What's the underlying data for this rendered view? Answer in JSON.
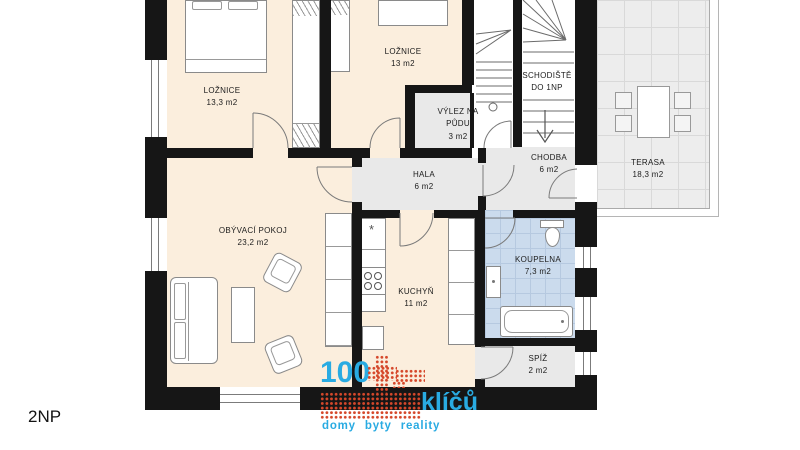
{
  "floor_label": "2NP",
  "rooms": [
    {
      "name": "LOŽNICE",
      "area": "13,3 m2"
    },
    {
      "name": "LOŽNICE",
      "area": "13 m2"
    },
    {
      "name": "VÝLEZ NA PŮDU",
      "area": "3 m2"
    },
    {
      "name": "SCHODIŠTĚ DO 1NP",
      "area": ""
    },
    {
      "name": "CHODBA",
      "area": "6 m2"
    },
    {
      "name": "TERASA",
      "area": "18,3 m2"
    },
    {
      "name": "HALA",
      "area": "6 m2"
    },
    {
      "name": "OBÝVACÍ POKOJ",
      "area": "23,2 m2"
    },
    {
      "name": "KUCHYŇ",
      "area": "11 m2"
    },
    {
      "name": "KOUPELNA",
      "area": "7,3 m2"
    },
    {
      "name": "SPÍŽ",
      "area": "2 m2"
    }
  ],
  "markers": {
    "sink": "*"
  },
  "logo": {
    "number": "100",
    "word": "klíčů",
    "tagline": "domy byty reality",
    "blue": "#29abe2",
    "red": "#d5472a"
  },
  "colors": {
    "wall": "#161616",
    "floor_room": "#fbeedd",
    "floor_hall": "#e9e9e9",
    "floor_bath": "#cbdbed",
    "floor_terrace": "#ededed"
  }
}
